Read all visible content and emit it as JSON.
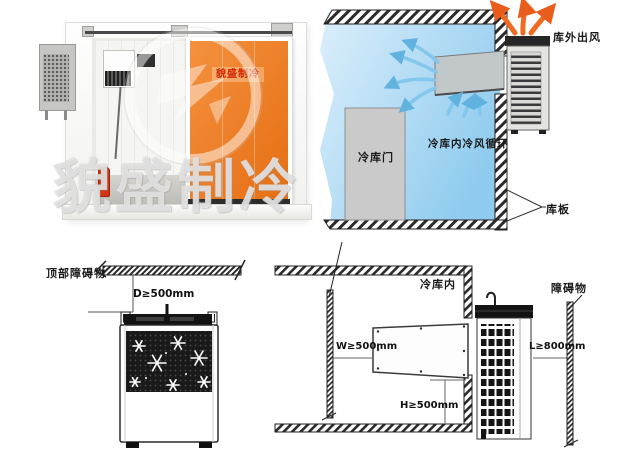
{
  "photo": {
    "watermark_text": "貌盛制冷",
    "door_brand_text": "貌盛制冷"
  },
  "airflow_diagram": {
    "outdoor_air_label": "库外出风",
    "circulation_label": "冷库内冷风循环",
    "door_label": "冷库门",
    "panel_label": "库板"
  },
  "top_clearance_diagram": {
    "obstacle_label": "顶部障碍物",
    "clearance_d": "D≥500mm"
  },
  "side_clearance_diagram": {
    "room_label": "冷库内",
    "obstacle_label": "障碍物",
    "clearance_w": "W≥500mm",
    "clearance_h": "H≥500mm",
    "clearance_l": "L≥800mm"
  },
  "colors": {
    "door_orange": "#e8751a",
    "brand_red": "#cf2600",
    "room_blue": "#9fd2f0",
    "cold_air_arrow": "#84c7ec",
    "warm_air_arrow": "#ef6b21"
  }
}
